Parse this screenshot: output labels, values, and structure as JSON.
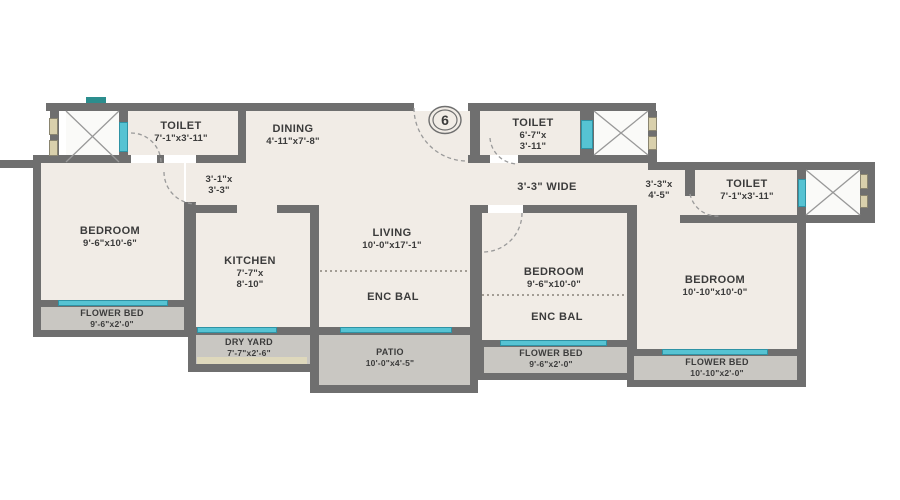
{
  "unit": {
    "number": "6"
  },
  "colors": {
    "wall": "#6f6f6f",
    "floor": "#f1ece6",
    "outdoor": "#c9c7c2",
    "window": "#56c3d3",
    "duct": "#d9d0ac",
    "shaft": "#fafaf8",
    "text": "#3b3b3b"
  },
  "rooms": {
    "toilet_top_left": {
      "name": "TOILET",
      "dims": "7'-1\"x3'-11\""
    },
    "dining": {
      "name": "DINING",
      "dims": "4'-11\"x7'-8\""
    },
    "toilet_top_center": {
      "name": "TOILET",
      "dims_line1": "6'-7\"x",
      "dims_line2": "3'-11\""
    },
    "toilet_right": {
      "name": "TOILET",
      "dims": "7'-1\"x3'-11\""
    },
    "bedroom_left": {
      "name": "BEDROOM",
      "dims": "9'-6\"x10'-6\""
    },
    "kitchen": {
      "name": "KITCHEN",
      "dims_line1": "7'-7\"x",
      "dims_line2": "8'-10\""
    },
    "living": {
      "name": "LIVING",
      "dims": "10'-0\"x17'-1\""
    },
    "enc_bal_living": {
      "name": "ENC BAL"
    },
    "bedroom_middle": {
      "name": "BEDROOM",
      "dims": "9'-6\"x10'-0\""
    },
    "enc_bal_bedroom": {
      "name": "ENC BAL"
    },
    "bedroom_right": {
      "name": "BEDROOM",
      "dims": "10'-10\"x10'-0\""
    },
    "flower_bed_left": {
      "name": "FLOWER BED",
      "dims": "9'-6\"x2'-0\""
    },
    "dry_yard": {
      "name": "DRY YARD",
      "dims": "7'-7\"x2'-6\""
    },
    "patio": {
      "name": "PATIO",
      "dims": "10'-0\"x4'-5\""
    },
    "flower_bed_middle": {
      "name": "FLOWER BED",
      "dims": "9'-6\"x2'-0\""
    },
    "flower_bed_right": {
      "name": "FLOWER BED",
      "dims": "10'-10\"x2'-0\""
    }
  },
  "passages": {
    "hall_left": {
      "dims_line1": "3'-1\"x",
      "dims_line2": "3'-3\""
    },
    "hall_center": {
      "label": "3'-3\" WIDE"
    },
    "hall_right": {
      "dims_line1": "3'-3\"x",
      "dims_line2": "4'-5\""
    }
  }
}
